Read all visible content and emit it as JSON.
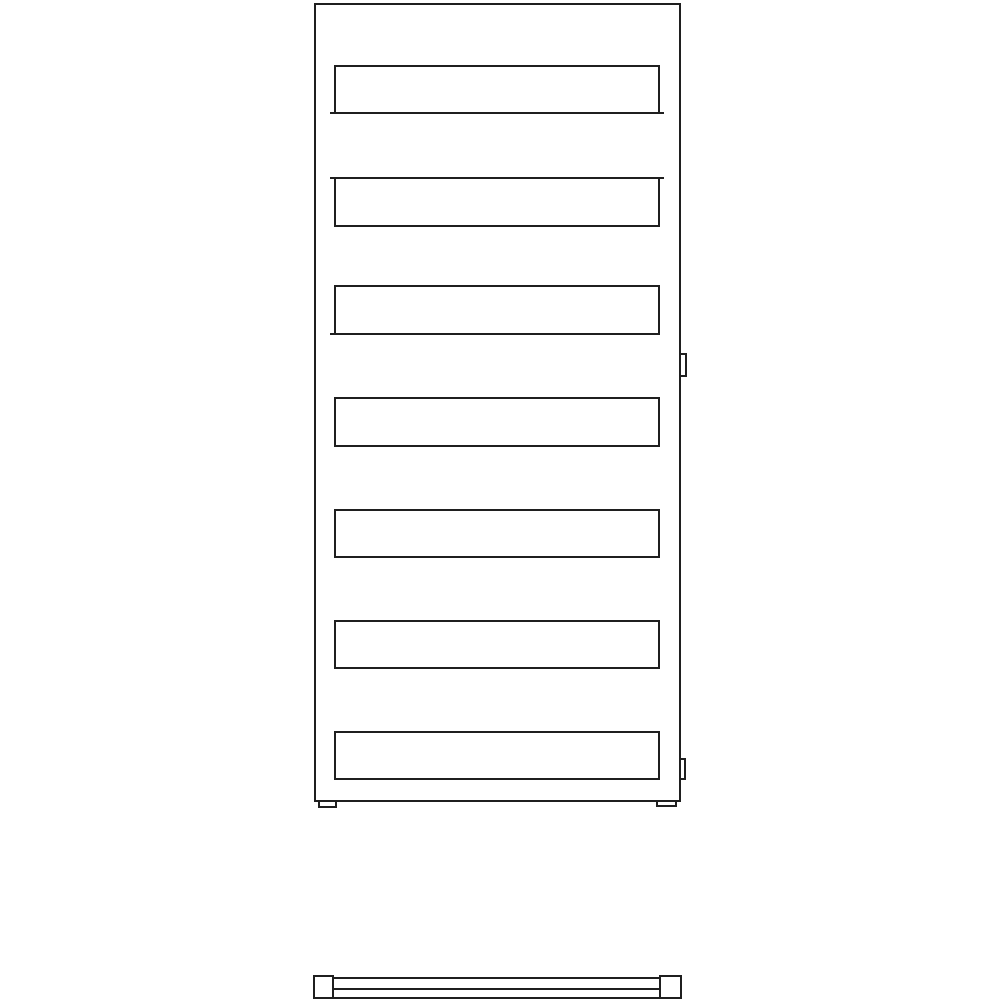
{
  "meta": {
    "description": "Technical line drawing of a flat-panel towel radiator: front elevation with seven horizontal slats, two right-side wall brackets, two base feet, and a slim plan view bar below",
    "background_color": "#ffffff",
    "stroke_color": "#1f1f1f",
    "stroke_width_px": 2,
    "canvas": {
      "width": 1000,
      "height": 1000
    },
    "slat_count": 7,
    "text_labels": []
  },
  "drawing": {
    "stroke_color": "#1f1f1f",
    "views": {
      "front_view": {
        "label": "radiator-front-elevation",
        "shapes": [
          {
            "name": "radiator-frame",
            "kind": "rect",
            "x": 314,
            "y": 3,
            "w": 367,
            "h": 799
          },
          {
            "name": "heating-slat-1",
            "kind": "rect",
            "x": 334,
            "y": 65,
            "w": 326,
            "h": 49
          },
          {
            "name": "heating-slat-2",
            "kind": "rect",
            "x": 334,
            "y": 177,
            "w": 326,
            "h": 50
          },
          {
            "name": "heating-slat-3",
            "kind": "rect",
            "x": 334,
            "y": 285,
            "w": 326,
            "h": 50
          },
          {
            "name": "heating-slat-4",
            "kind": "rect",
            "x": 334,
            "y": 397,
            "w": 326,
            "h": 50
          },
          {
            "name": "heating-slat-5",
            "kind": "rect",
            "x": 334,
            "y": 509,
            "w": 326,
            "h": 49
          },
          {
            "name": "heating-slat-6",
            "kind": "rect",
            "x": 334,
            "y": 620,
            "w": 326,
            "h": 49
          },
          {
            "name": "heating-slat-7",
            "kind": "rect",
            "x": 334,
            "y": 731,
            "w": 326,
            "h": 49
          },
          {
            "name": "slat-1-corner-tick-bottom-left",
            "kind": "bar",
            "x": 330,
            "y": 112,
            "w": 6,
            "h": 2
          },
          {
            "name": "slat-1-corner-tick-bottom-right",
            "kind": "bar",
            "x": 658,
            "y": 112,
            "w": 6,
            "h": 2
          },
          {
            "name": "slat-2-corner-tick-top-left",
            "kind": "bar",
            "x": 330,
            "y": 177,
            "w": 6,
            "h": 2
          },
          {
            "name": "slat-2-corner-tick-top-right",
            "kind": "bar",
            "x": 658,
            "y": 177,
            "w": 6,
            "h": 2
          },
          {
            "name": "slat-3-corner-tick-bottom-left",
            "kind": "bar",
            "x": 330,
            "y": 333,
            "w": 6,
            "h": 2
          },
          {
            "name": "side-bracket-upper",
            "kind": "rect",
            "x": 679,
            "y": 353,
            "w": 8,
            "h": 24
          },
          {
            "name": "side-bracket-lower",
            "kind": "rect",
            "x": 679,
            "y": 758,
            "w": 7,
            "h": 22
          },
          {
            "name": "base-foot-left",
            "kind": "rect",
            "x": 318,
            "y": 800,
            "w": 19,
            "h": 8
          },
          {
            "name": "base-foot-right",
            "kind": "rect",
            "x": 656,
            "y": 800,
            "w": 21,
            "h": 7
          }
        ]
      },
      "bottom_view": {
        "label": "radiator-plan-view",
        "shapes": [
          {
            "name": "plan-end-cap-left",
            "kind": "rect",
            "x": 313,
            "y": 975,
            "w": 21,
            "h": 24
          },
          {
            "name": "plan-end-cap-right",
            "kind": "rect",
            "x": 659,
            "y": 975,
            "w": 23,
            "h": 24
          },
          {
            "name": "plan-bar-body",
            "kind": "rect",
            "x": 332,
            "y": 977,
            "w": 329,
            "h": 22
          },
          {
            "name": "plan-bar-inner-line",
            "kind": "bar",
            "x": 334,
            "y": 988,
            "w": 325,
            "h": 2
          }
        ]
      }
    }
  }
}
